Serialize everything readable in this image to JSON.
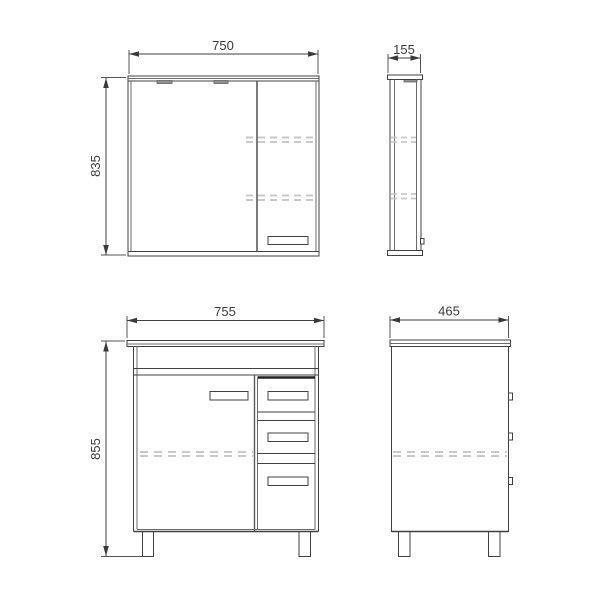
{
  "canvas": {
    "background": "#ffffff",
    "line_color": "#404040",
    "thin_line_color": "#6b6b6b",
    "dash_color": "#c9c9c9",
    "fixture_fill": "#929292"
  },
  "views": {
    "mirror_front": {
      "width_label": "750",
      "height_label": "835"
    },
    "mirror_side": {
      "depth_label": "155"
    },
    "vanity_front": {
      "width_label": "755",
      "height_label": "855"
    },
    "vanity_side": {
      "depth_label": "465"
    }
  }
}
